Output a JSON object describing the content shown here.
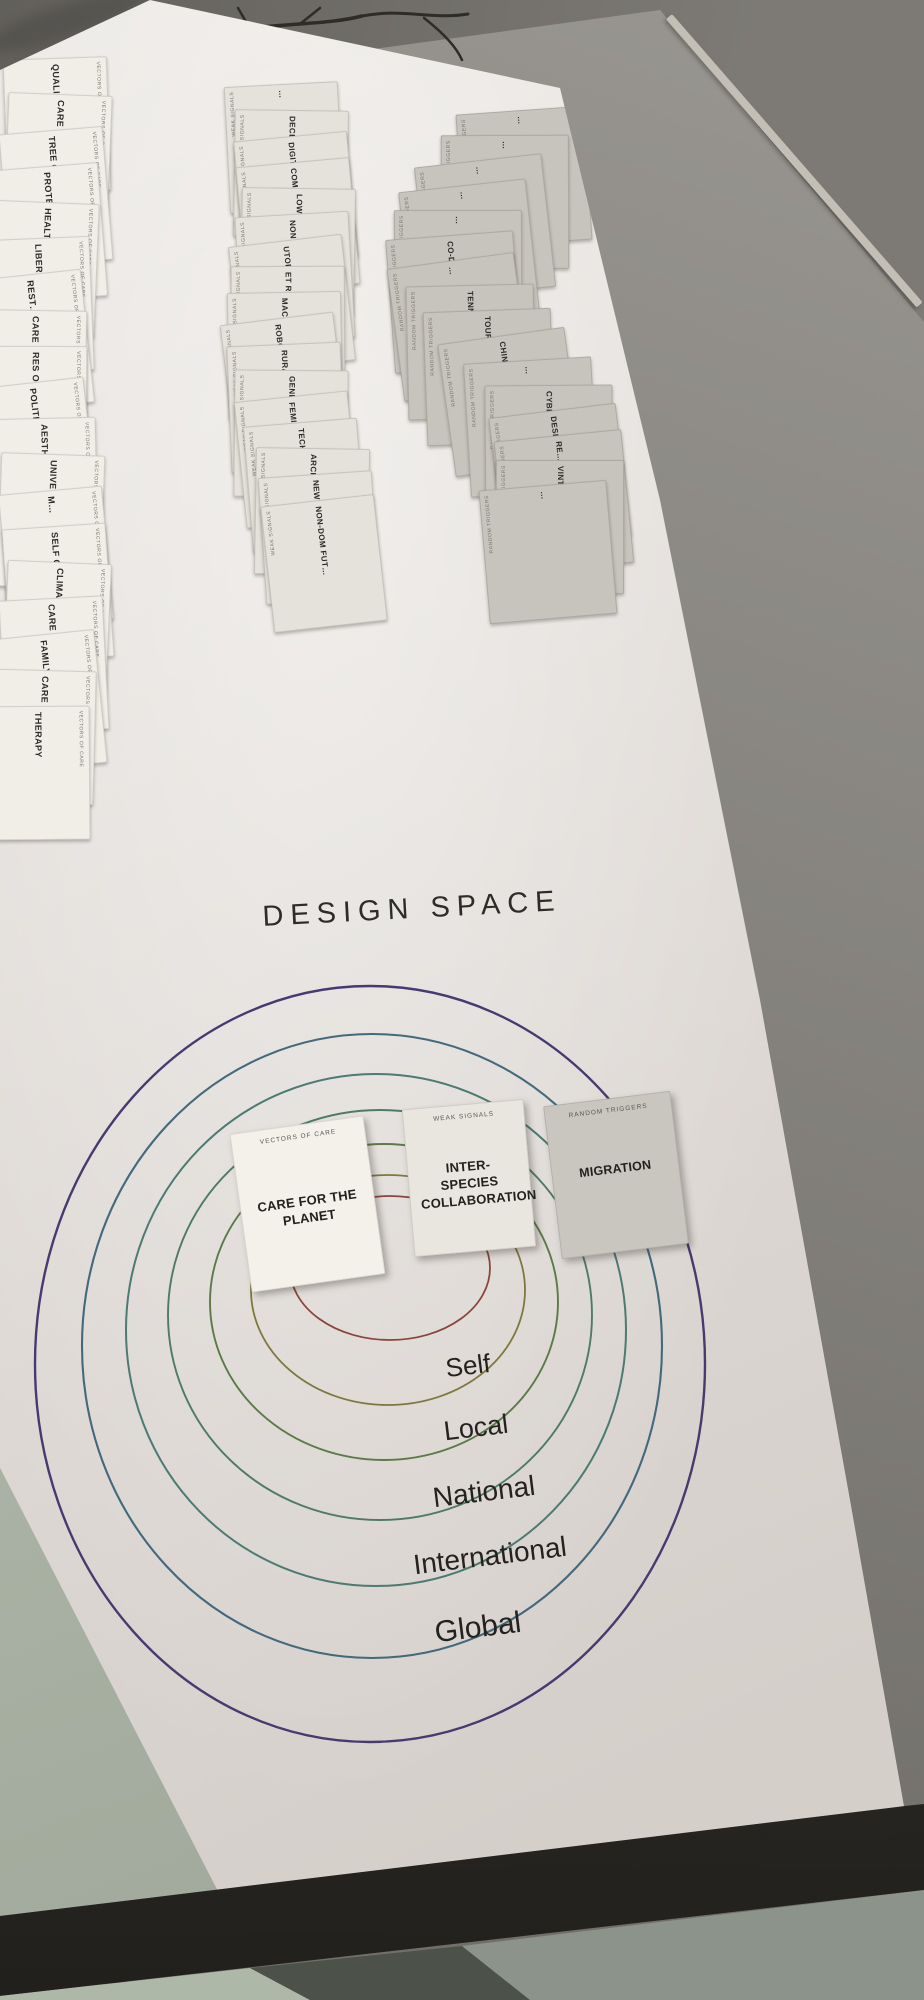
{
  "scene_colors": {
    "wall": "#75726d",
    "floor_right": "#8e8b85",
    "baseboard": "#c3bfb7",
    "poster": "#e9e5e1",
    "branch": "#2f2c28",
    "wall_shadow": "#4b4945",
    "floor_green_left": "#b2bcac",
    "table_edge": "#33312c",
    "floor_bottom_left": "#aeb8a8",
    "floor_bottom_dark": "#4c514a",
    "floor_bottom_right": "#8c938a"
  },
  "diagram": {
    "title": "DESIGN SPACE",
    "zone_labels": [
      "Self",
      "Local",
      "National",
      "International",
      "Global"
    ],
    "ring_colors": [
      "#8a453c",
      "#7d7840",
      "#5c7a49",
      "#4f7a66",
      "#4d7a72",
      "#44687c",
      "#473a6e"
    ],
    "placed_cards": [
      {
        "deck": "VECTORS OF CARE",
        "title": "CARE FOR THE PLANET",
        "color": "#f4f1ea"
      },
      {
        "deck": "WEAK SIGNALS",
        "title": "INTER-SPECIES COLLABORATION",
        "color": "#e9e6df"
      },
      {
        "deck": "RANDOM TRIGGERS",
        "title": "MIGRATION",
        "color": "#c9c6bf"
      }
    ]
  },
  "decks": [
    {
      "name": "VECTORS OF CARE",
      "card_color": "#f1eee8",
      "cards": [
        "QUALITY…",
        "CARE FOR PLANTS",
        "TREE OF THE…",
        "PROTECT OF CARE…",
        "HEALTH CARE…",
        "LIBER…",
        "REST…",
        "CARE FOR ANIMALS",
        "RES O DE…",
        "POLITICS AS CARE",
        "AESTH OF…",
        "UNIVE BASIC I…",
        "M…",
        "SELF CARE",
        "CLIMATE CONSCIE…",
        "CARE FOR THE HUMAN",
        "FAMILY CARE",
        "CARE FOR PRIV…",
        "THERAPY"
      ]
    },
    {
      "name": "WEAK SIGNALS",
      "card_color": "#e5e2db",
      "cards": [
        "…",
        "DECELER…",
        "DIGITAL DETO…",
        "COMM STO…",
        "LOW CARBON LIFE…",
        "NON VITRO FUTU…",
        "UTOPIA A TRANS…",
        "ET RES…",
        "MACHINE NON-HUM…",
        "ROBOT FABRICA…",
        "RURAL FU…",
        "GENDER FLUIDITY",
        "FEMINI FUTUR…",
        "TECHN CAPITAL FUTUR…",
        "ARCHIV…",
        "NEW EURO BAUHA…",
        "NON-DOM FUT…"
      ]
    },
    {
      "name": "RANDOM TRIGGERS",
      "card_color": "#c7c4bd",
      "cards": [
        "…",
        "…",
        "…",
        "…",
        "…",
        "CO-DESIGN…",
        "…",
        "TENNIS",
        "TOUR…",
        "CHIN…",
        "…",
        "CYBERP…",
        "DESIGN…",
        "RE…",
        "VINTAG…",
        "…"
      ]
    }
  ]
}
